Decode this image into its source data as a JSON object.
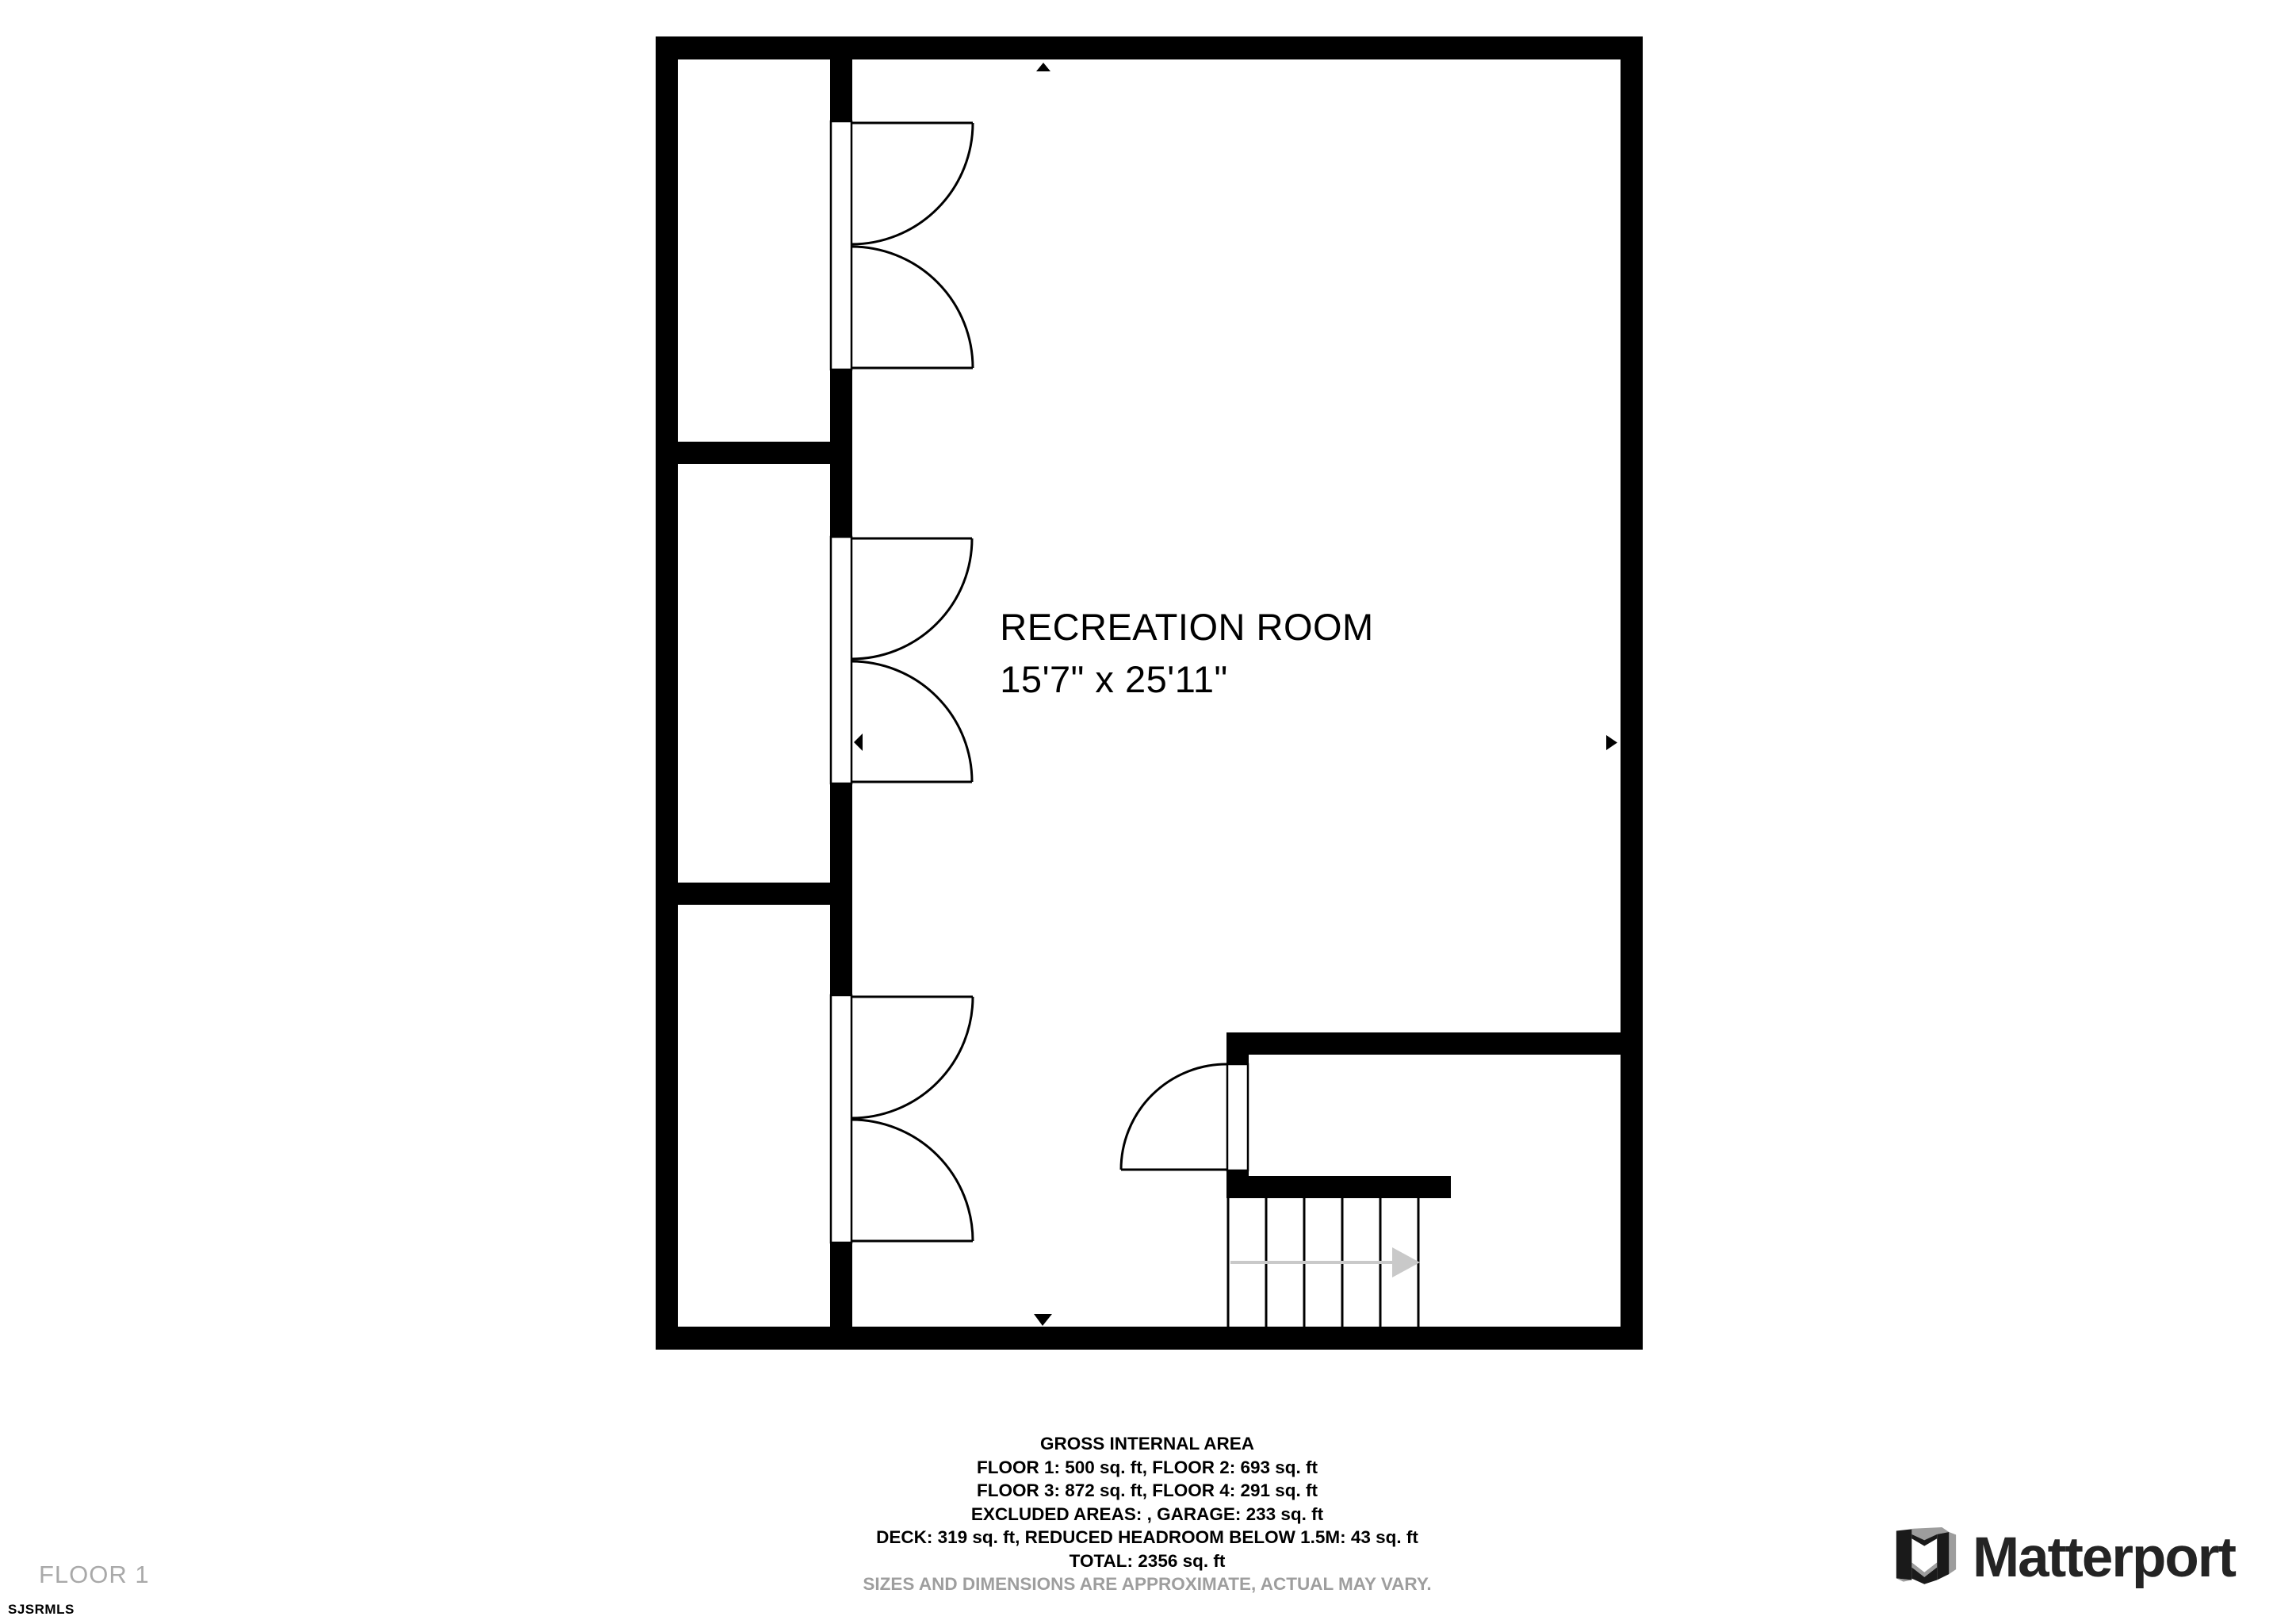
{
  "plan": {
    "room_label": {
      "name": "RECREATION ROOM",
      "dimensions": "15'7\" x 25'11\""
    },
    "staircase": {
      "step_count": 5,
      "direction": "right"
    },
    "closet_count": 3,
    "floor_shown": "FLOOR 1"
  },
  "area_summary": {
    "title": "GROSS INTERNAL AREA",
    "lines": [
      "FLOOR 1: 500 sq. ft, FLOOR 2: 693 sq. ft",
      "FLOOR 3: 872 sq. ft, FLOOR 4: 291 sq. ft",
      "EXCLUDED AREAS: , GARAGE: 233 sq. ft",
      "DECK: 319 sq. ft, REDUCED HEADROOM BELOW 1.5M: 43 sq. ft",
      "TOTAL: 2356 sq. ft"
    ],
    "disclaimer": "SIZES AND DIMENSIONS ARE APPROXIMATE, ACTUAL MAY VARY."
  },
  "footer": {
    "floor_label": "FLOOR 1",
    "mls_code": "SJSRMLS"
  },
  "branding": {
    "wordmark": "Matterport",
    "mark_icon": "matterport-cube-logo"
  },
  "colors": {
    "wall": "#000000",
    "background": "#ffffff",
    "stair_arrow_gray": "#c9c9c9",
    "floor_label_gray": "#a9a9a9",
    "disclaimer_gray": "#9e9e9e",
    "logo_dark": "#242424",
    "logo_gray": "#9d9d9d"
  }
}
